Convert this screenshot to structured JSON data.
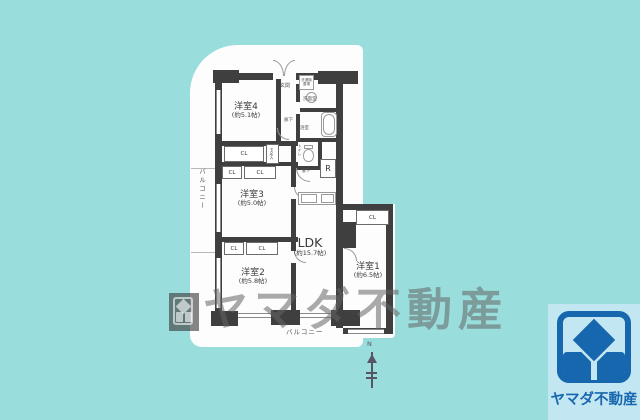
{
  "colors": {
    "background": "#99dedd",
    "wall": "#3f3f3f",
    "logo_blue": "#1767ae",
    "logo_panel": "#c3e6f3"
  },
  "plan": {
    "rooms": [
      {
        "name": "洋室1",
        "size": "(約6.5帖)"
      },
      {
        "name": "洋室2",
        "size": "(約5.8帖)"
      },
      {
        "name": "洋室3",
        "size": "(約5.0帖)"
      },
      {
        "name": "洋室4",
        "size": "(約5.1帖)"
      },
      {
        "name": "LDK",
        "size": "(約15.7帖)"
      }
    ],
    "labels": {
      "entrance": "玄関",
      "hallway": "廊下",
      "washroom": "洗面室",
      "bathroom": "浴室",
      "laundry": "洗濯機置場",
      "toilet": "トイレ",
      "shoe_cabinet": "下足入",
      "closet": "CL",
      "refrigerator": "R",
      "balcony": "バルコニー",
      "north": "N"
    }
  },
  "watermark": {
    "text": "ヤマダ不動産"
  },
  "logo": {
    "company": "ヤマダ不動産"
  }
}
